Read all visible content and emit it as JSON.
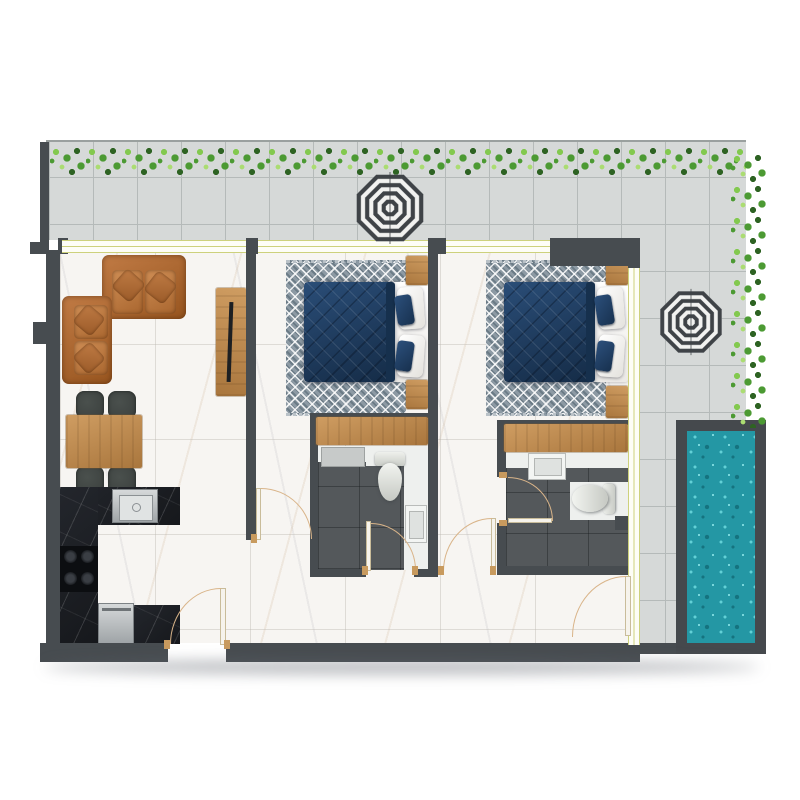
{
  "scene": {
    "kind": "residential-apartment-floor-plan",
    "view": "top-down-2d-render",
    "visible_text": "none"
  },
  "palette": {
    "wall": "#474c50",
    "terraceTile": "#d6d9d8",
    "tileLine": "#b5bab9",
    "marble": "#f7f5f2",
    "hedgeDark": "#2e6323",
    "hedgeMid": "#4c9a33",
    "hedgeLight": "#83c94f",
    "hedgeLighter": "#abdc72",
    "poolFrame": "#45494d",
    "poolWater": "#2497a4",
    "poolLight": "#62d0d6",
    "poolDark": "#15737f",
    "wood": "#c8965c",
    "woodDark": "#a9763d",
    "sofa": "#b56f3c",
    "sofaDark": "#97551f",
    "navy": "#1f3f63",
    "navyDark": "#152c47",
    "rug": "#8d9aa4",
    "bathFloor": "#54585b",
    "black": "#16181c",
    "steel": "#b9bdc0",
    "chair": "#3a3f3d",
    "frameYellow": "#cdd17c",
    "doorArc": "#d9b489",
    "fixture": "#eef0ee",
    "umbrellaDark": "#3f4347",
    "umbrellaLight": "#f2f2f0",
    "shelf": "#c7cac9"
  },
  "inventory": {
    "zones": [
      "terrace-top",
      "terrace-right",
      "pool",
      "living-dining",
      "kitchen",
      "bedroom-1",
      "bathroom-1",
      "bedroom-2",
      "bathroom-2",
      "hallway"
    ],
    "counts": {
      "umbrellas": 2,
      "hedges": 2,
      "sofas": 2,
      "dining_chairs": 4,
      "dining_tables": 1,
      "tv_units": 1,
      "beds": 2,
      "rugs": 2,
      "nightstands": 4,
      "bath_vanities": 2,
      "toilets": 2,
      "bath_sinks": 2,
      "showers": 1,
      "kitchen_sinks": 1,
      "cooktop_burners": 4,
      "dishwashers": 1,
      "interior_doors": 6,
      "window_bands": 4,
      "pools": 1
    }
  }
}
